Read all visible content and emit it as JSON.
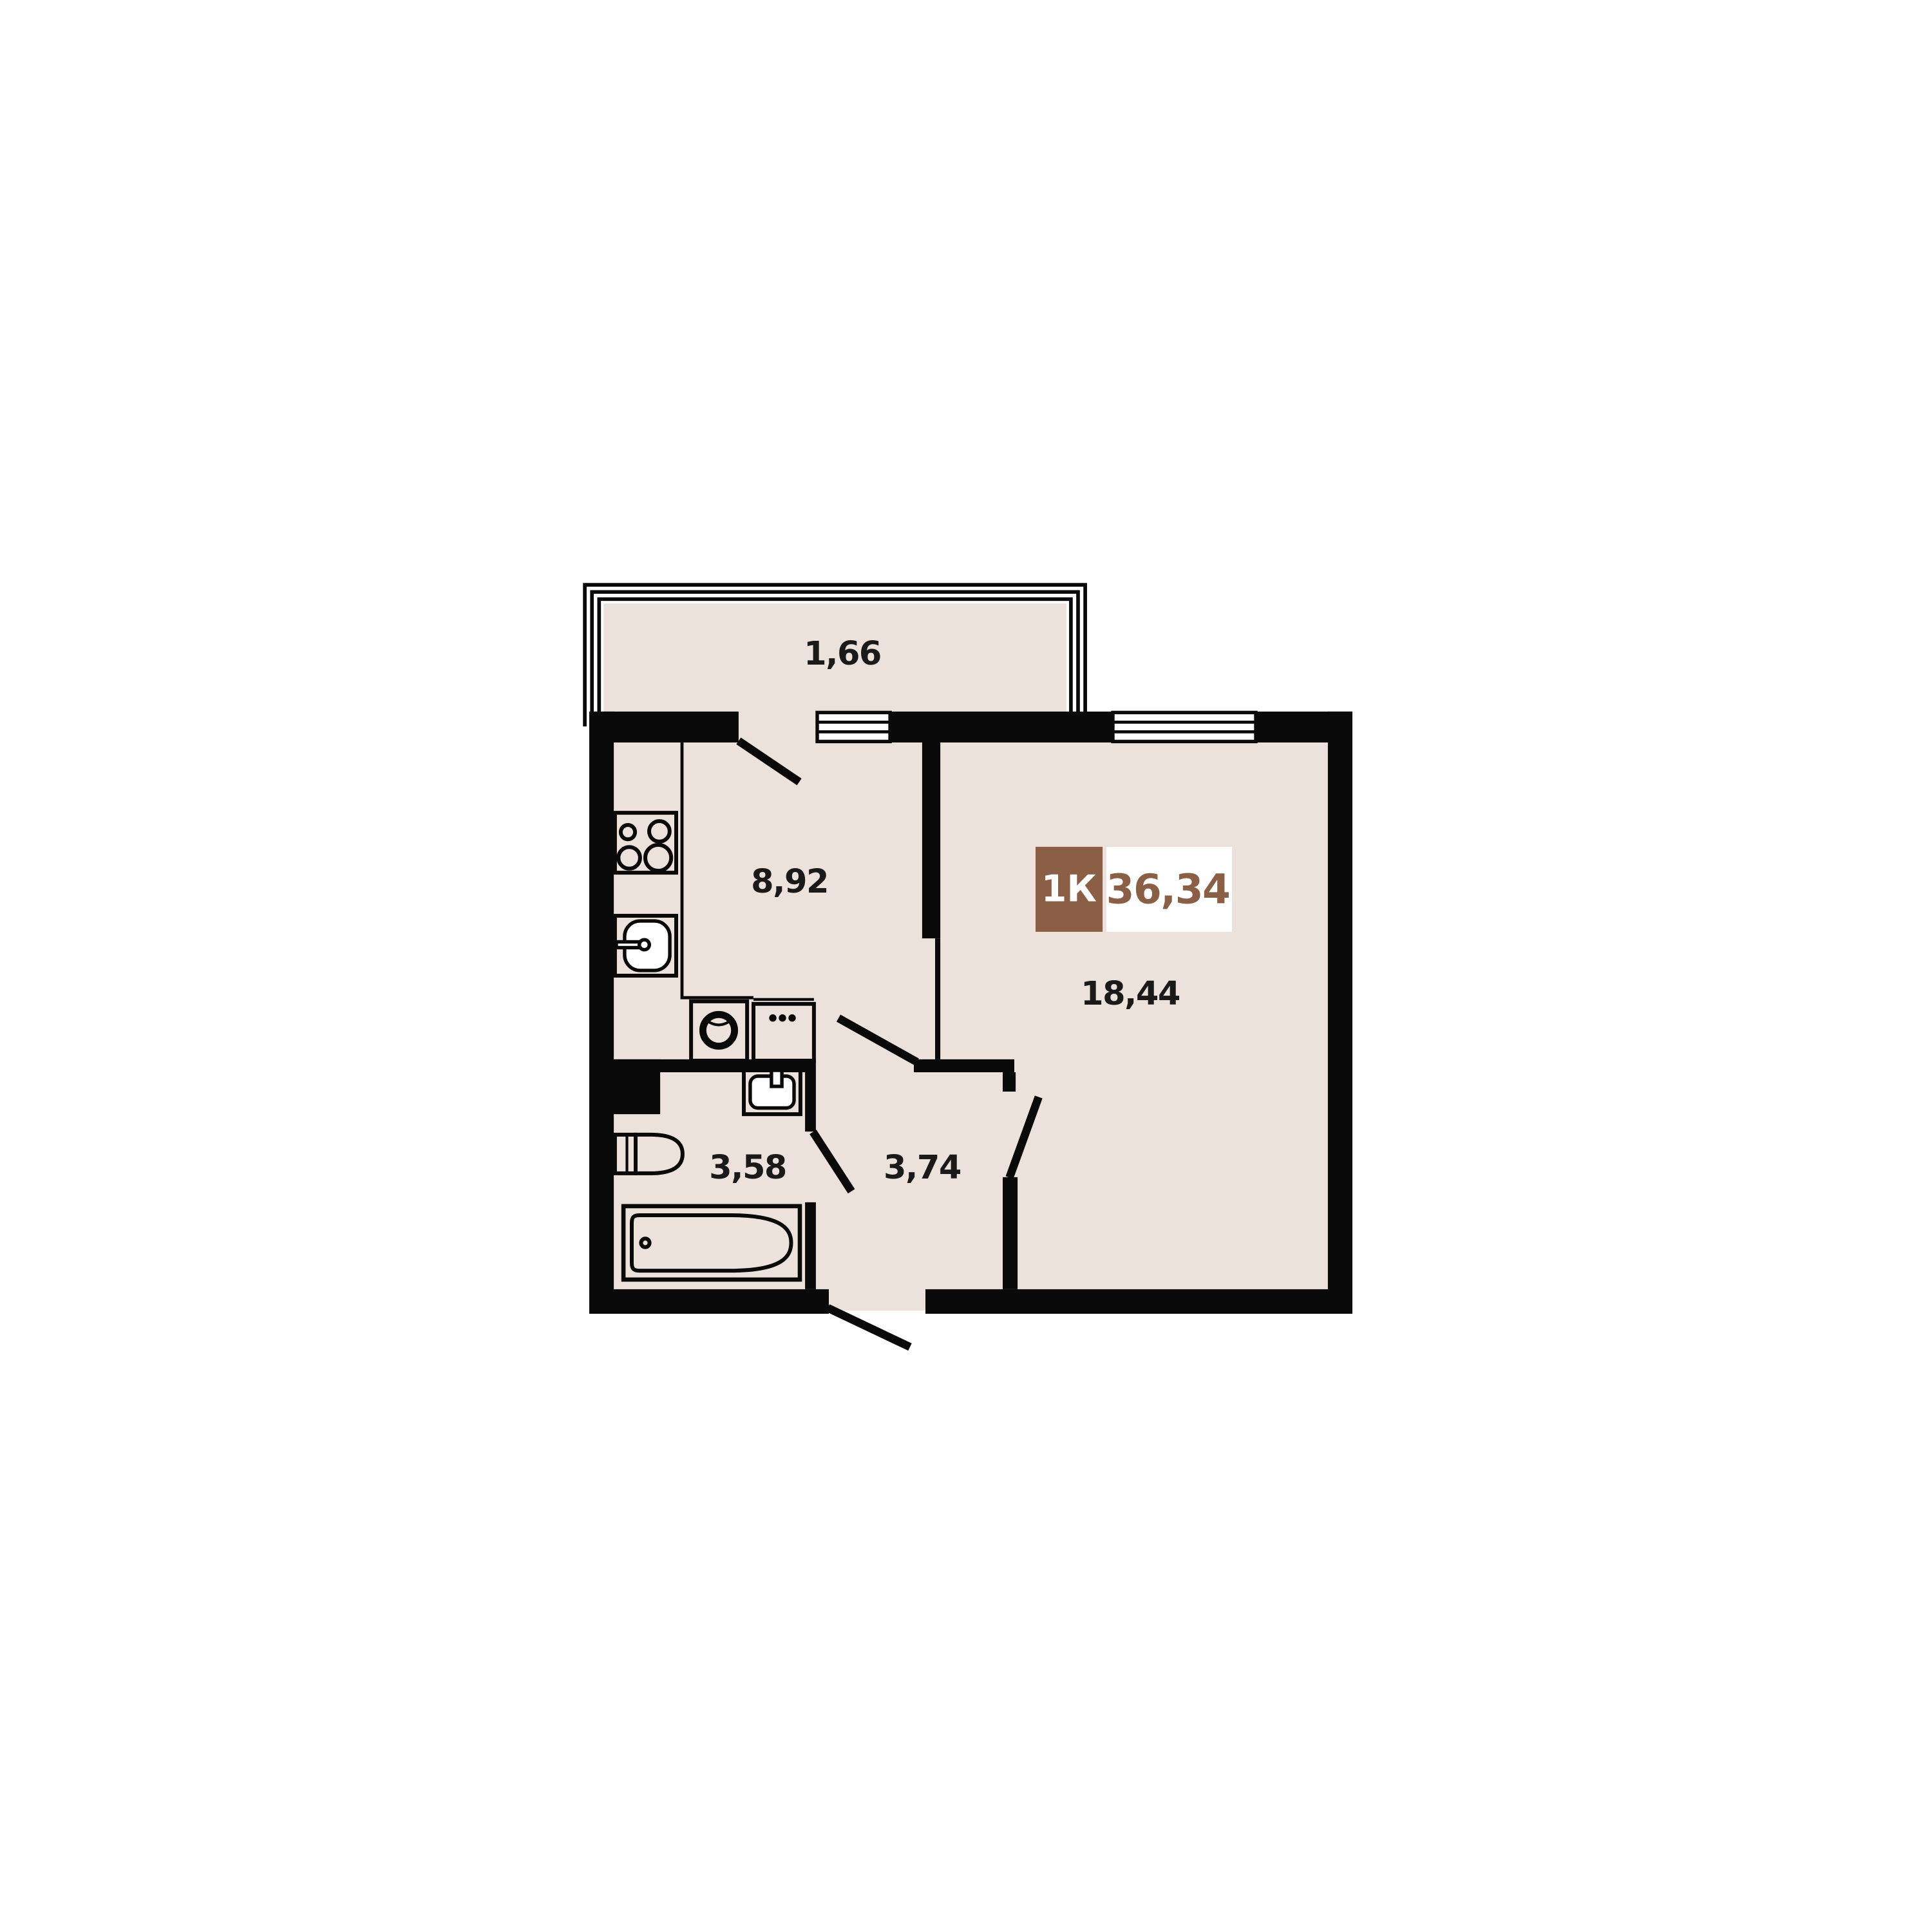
{
  "badge": {
    "room_type": "1К",
    "total_area": "36,34"
  },
  "rooms": {
    "balcony": {
      "area": "1,66"
    },
    "kitchen": {
      "area": "8,92"
    },
    "living_room": {
      "area": "18,44"
    },
    "bathroom": {
      "area": "3,58"
    },
    "hallway": {
      "area": "3,74"
    }
  },
  "fixtures": [
    "stove-icon",
    "kitchen-sink-icon",
    "washing-machine-icon",
    "counter-appliance-icon",
    "bathroom-sink-icon",
    "toilet-icon",
    "bathtub-icon",
    "window-icon",
    "door-swing-icon",
    "balcony-glazing-icon"
  ],
  "colors": {
    "background": "#FFFFFF",
    "floor": "#EDE1DB",
    "wall": "#0A0A0A",
    "accent_brown": "#8B5F46",
    "badge_text_on_brown": "#FFFFFF",
    "label_text": "#1A1A1A"
  }
}
